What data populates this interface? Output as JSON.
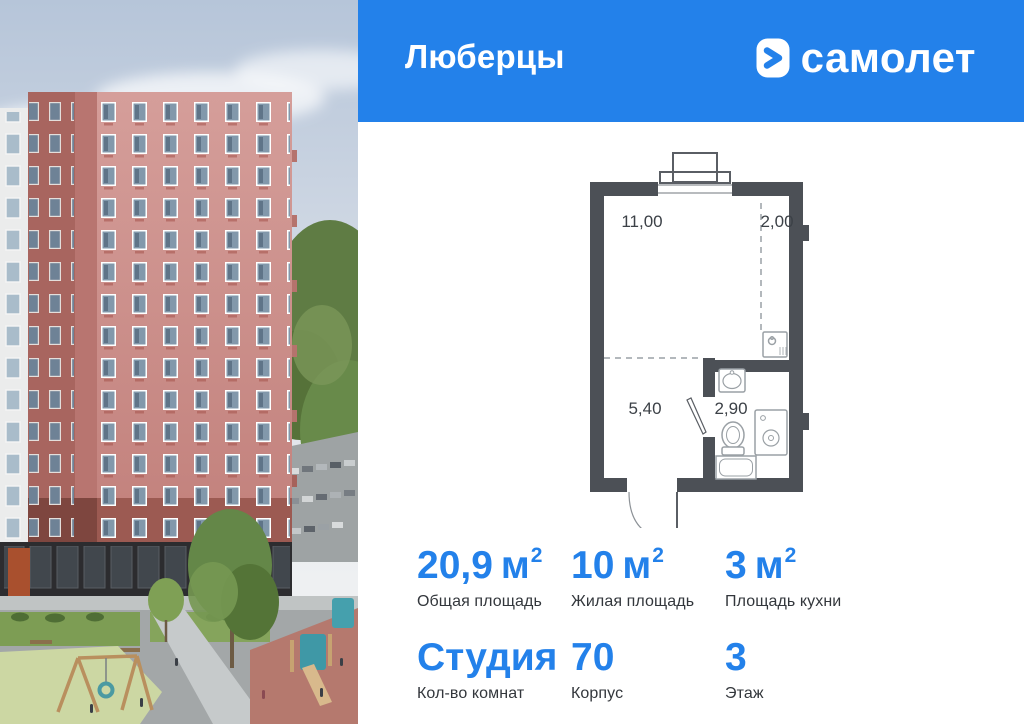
{
  "header": {
    "title": "Люберцы",
    "brand": "самолет"
  },
  "colors": {
    "accent": "#2381ea",
    "plan_wall": "#4c5056",
    "stat_value": "#2381ea"
  },
  "plan": {
    "rooms": [
      {
        "name": "living-room",
        "area": "11,00"
      },
      {
        "name": "kitchen-zone",
        "area": "2,00"
      },
      {
        "name": "hallway",
        "area": "5,40"
      },
      {
        "name": "bathroom",
        "area": "2,90"
      }
    ]
  },
  "stats": [
    {
      "value": "20,9",
      "unit": "м",
      "sup": "2",
      "label": "Общая площадь"
    },
    {
      "value": "10",
      "unit": "м",
      "sup": "2",
      "label": "Жилая площадь"
    },
    {
      "value": "3",
      "unit": "м",
      "sup": "2",
      "label": "Площадь кухни"
    },
    {
      "value": "Студия",
      "unit": "",
      "sup": "",
      "label": "Кол-во комнат"
    },
    {
      "value": "70",
      "unit": "",
      "sup": "",
      "label": "Корпус"
    },
    {
      "value": "3",
      "unit": "",
      "sup": "",
      "label": "Этаж"
    }
  ]
}
